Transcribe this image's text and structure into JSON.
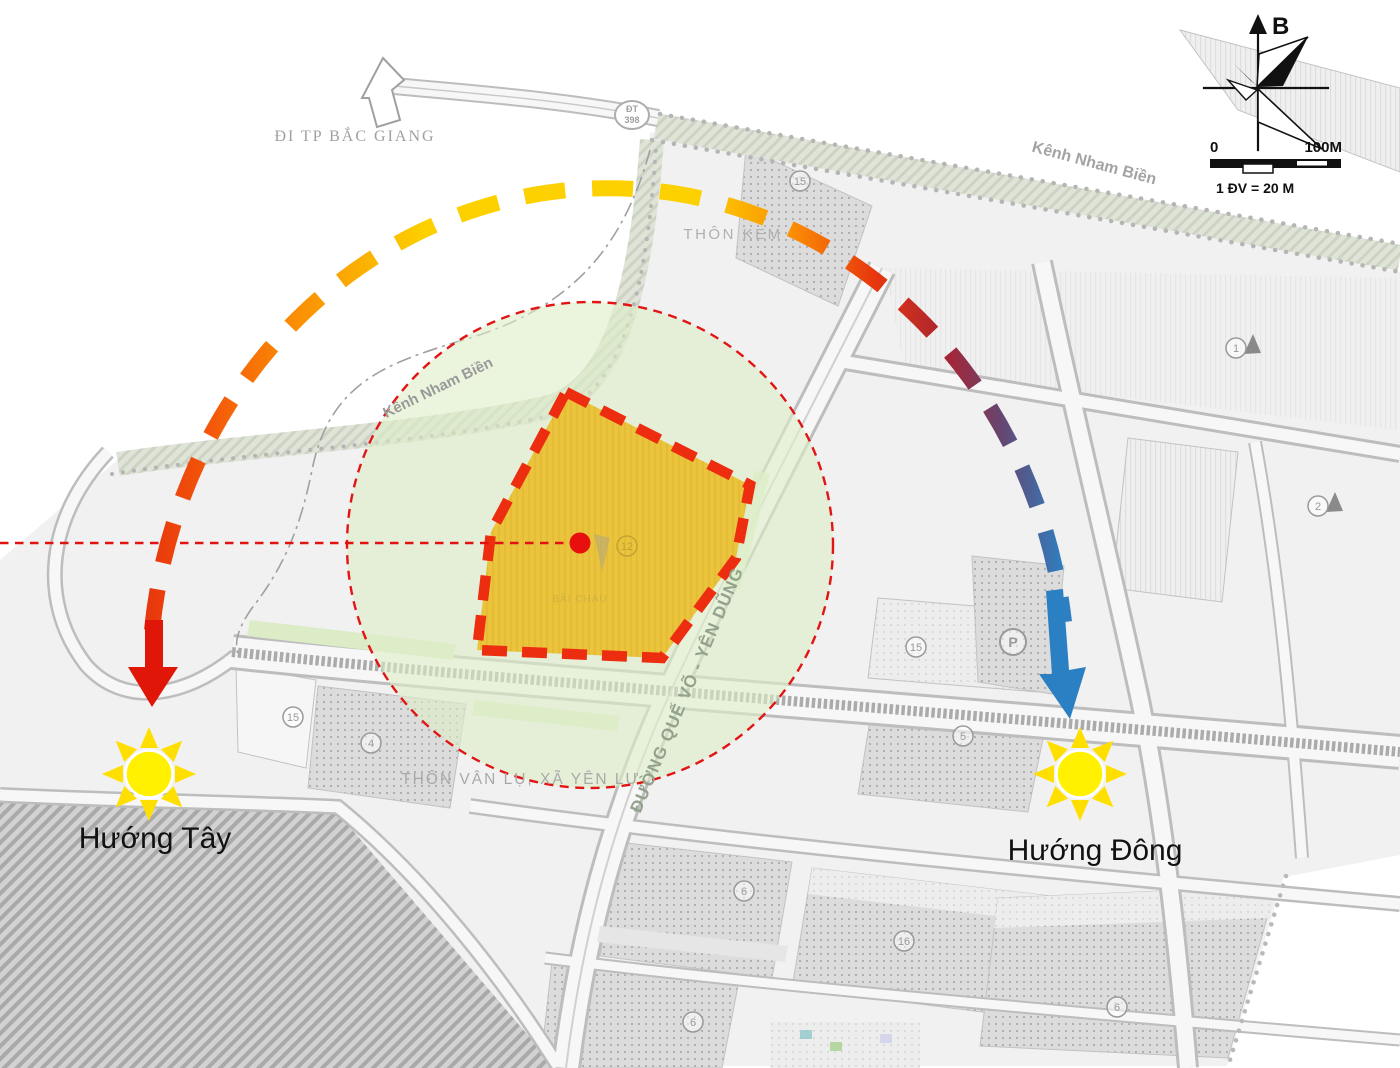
{
  "map": {
    "exit_road_label": "ĐI TP BẮC GIANG",
    "route_badge": {
      "line1": "ĐT",
      "line2": "398"
    },
    "canal_label_northeast": "Kênh Nham Biền",
    "canal_label_west": "Kênh Nham Biền",
    "hamlet_label_north": "THÔN KEM",
    "hamlet_label_south": "THÔN VÂN LỤ, XÃ YÊN LƯ",
    "main_road_label": "ĐƯỜNG QUẾ VÕ - YÊN DŨNG",
    "site": {
      "faint_label": "BÃI CHÁU",
      "fill_color": "#EAC43D",
      "border_color": "#ED2D0F",
      "buffer_circle_color": "#DDEEC8",
      "buffer_outline_color": "#E21414",
      "axis_line_color": "#E31212"
    },
    "badges": [
      {
        "n": "15",
        "x": 800,
        "y": 181
      },
      {
        "n": "1",
        "x": 1236,
        "y": 348,
        "tri": true
      },
      {
        "n": "2",
        "x": 1318,
        "y": 506,
        "tri": true
      },
      {
        "n": "15",
        "x": 916,
        "y": 647
      },
      {
        "n": "P",
        "x": 1013,
        "y": 642,
        "r": 13,
        "bold": true
      },
      {
        "n": "5",
        "x": 963,
        "y": 736
      },
      {
        "n": "15",
        "x": 293,
        "y": 717
      },
      {
        "n": "4",
        "x": 371,
        "y": 743
      },
      {
        "n": "6",
        "x": 744,
        "y": 891
      },
      {
        "n": "16",
        "x": 904,
        "y": 941
      },
      {
        "n": "6",
        "x": 693,
        "y": 1022
      },
      {
        "n": "6",
        "x": 1117,
        "y": 1007
      },
      {
        "n": "12",
        "x": 627,
        "y": 546,
        "faint": true
      }
    ]
  },
  "sun_path": {
    "west_label": "Hướng Tây",
    "east_label": "Hướng Đông",
    "west_arrow_color": "#E01708",
    "east_arrow_color": "#2B80C4",
    "sun_color": "#FFF100",
    "gradient_stops": [
      {
        "offset": 0,
        "color": "#E8380D"
      },
      {
        "offset": 0.07,
        "color": "#F45B09"
      },
      {
        "offset": 0.16,
        "color": "#FB9004"
      },
      {
        "offset": 0.3,
        "color": "#FDD000"
      },
      {
        "offset": 0.6,
        "color": "#FDD000"
      },
      {
        "offset": 0.7,
        "color": "#FB9004"
      },
      {
        "offset": 0.79,
        "color": "#E8380D"
      },
      {
        "offset": 0.87,
        "color": "#A92432"
      },
      {
        "offset": 0.93,
        "color": "#67456F"
      },
      {
        "offset": 1,
        "color": "#2E7FC1"
      }
    ]
  },
  "compass": {
    "north_label": "B"
  },
  "scale_bar": {
    "start": "0",
    "end": "100M",
    "unit": "1 ĐV = 20 M"
  }
}
